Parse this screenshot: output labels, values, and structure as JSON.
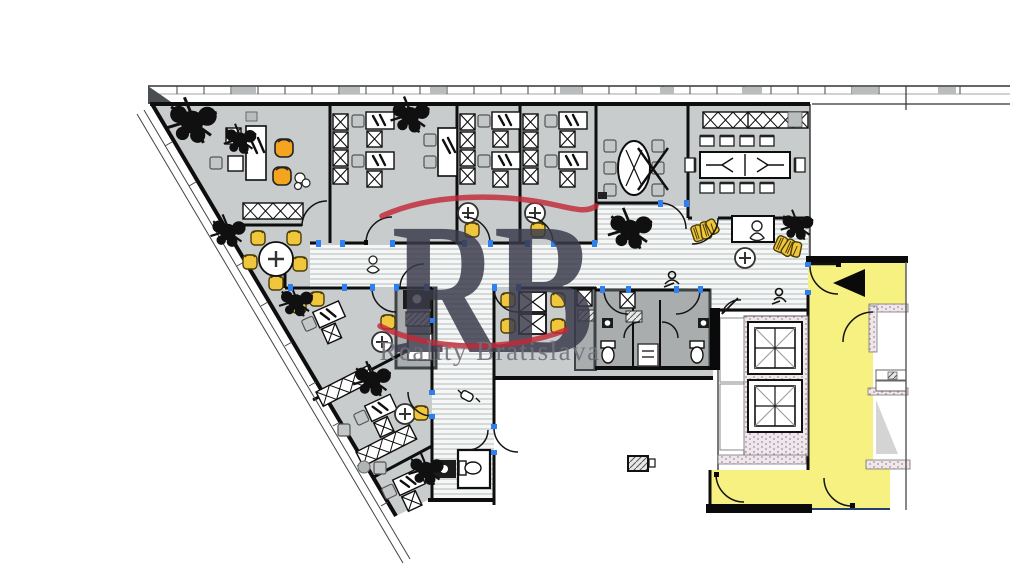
{
  "watermark": {
    "letters": "RB",
    "subtitle": "Reality Bratislava"
  },
  "colors": {
    "floor": "#c8cccc",
    "stripe_bg": "#f5f6f6",
    "stripe": "#d4d8d9",
    "wall": "#0e0e0e",
    "dark_room": "#a9adae",
    "dark_wall": "#3f4345",
    "yellow": "#f6f180",
    "gold": "#f0c63c",
    "orange": "#f5a41f",
    "chair_gray": "#c3c7c8",
    "door_blue": "#2e7ff0",
    "logo_red": "#c22838",
    "logo_letters": "#3b3b4b",
    "logo_text": "#70707c",
    "speckle_fill": "#efe7ec",
    "speckle_dot": "#a7899c",
    "plant": "#101010",
    "gray_seg": "#b9bdbe"
  }
}
